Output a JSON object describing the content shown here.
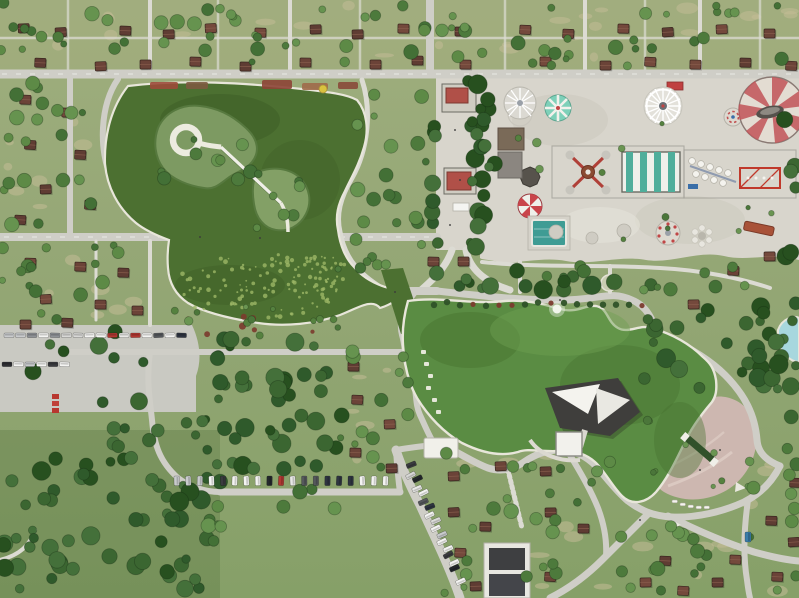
{
  "scene": {
    "type": "aerial-photo",
    "description": "Top-down drone photograph of a large urban park: two organic green ponds joined by a channel, an island with a white circular walkway and diagonal footbridge, a lakeside stage with white canopies, a pink waterfront plaza, an amusement park with striped tents and rides, grids of picnic cells with brown-roofed cabins, tree groves, and parking lots filled with cars.",
    "landmarks": [
      "upper pond with island spiral walkway",
      "causeway over upper pond",
      "lily-pad lobe",
      "channel footbridge",
      "lower pond with fountain",
      "lakeside stage",
      "pink plaza with water rill",
      "amusement park",
      "picnic cabin grid",
      "left parking lot",
      "diagonal parking road",
      "bottom-left forest",
      "waterslide pool at right edge"
    ]
  },
  "palette": {
    "grass_base": "#93a674",
    "grass_top": "#a8ad7e",
    "dirt": "#c2bc96",
    "road": "#cfcec7",
    "road_minor": "#dcdbd3",
    "concrete": "#d8d5cc",
    "lot": "#c9c9c2",
    "water_upper": "#4c7031",
    "water_lower": "#5a8c43",
    "water_edge": "#e8e6da",
    "pool": "#a7d7de",
    "plaza": "#cdb7b0",
    "plaza_path": "#decdc6",
    "rill": "#31512a",
    "stage": "#3f3e3c",
    "canopy": "#f4f3ee",
    "tent_red": "#c25458",
    "tent_cream": "#e3dcd2",
    "tent_teal": "#4fae9b",
    "stripe_white": "#eef0ea",
    "mint": "#7ed0b9",
    "umbrella_red": "#c9454b",
    "red_kiosk": "#b05048",
    "truss_red": "#c0392b"
  },
  "trees": {
    "dark": [
      "#2f5a2b",
      "#3b6631",
      "#27501f",
      "#44703a"
    ],
    "mid": [
      "#4d7a3c",
      "#5d8a46",
      "#437036",
      "#66934f"
    ],
    "small": [
      "#55813f",
      "#6a9552",
      "#4b763a"
    ],
    "edge": "rgba(20,40,16,.35)",
    "regions": [
      [
        0,
        2,
        795,
        64,
        70,
        "mid",
        1
      ],
      [
        2,
        80,
        100,
        152,
        20,
        "mid",
        2
      ],
      [
        2,
        244,
        150,
        84,
        16,
        "mid",
        3
      ],
      [
        185,
        334,
        158,
        148,
        44,
        "dark",
        4
      ],
      [
        0,
        458,
        208,
        138,
        56,
        "dark",
        5
      ],
      [
        336,
        350,
        72,
        118,
        13,
        "mid",
        6
      ],
      [
        430,
        452,
        180,
        144,
        26,
        "mid",
        7
      ],
      [
        616,
        522,
        182,
        74,
        18,
        "mid",
        8
      ],
      [
        742,
        440,
        56,
        82,
        9,
        "mid",
        9
      ],
      [
        466,
        80,
        30,
        182,
        16,
        "dark",
        10
      ],
      [
        428,
        82,
        10,
        166,
        8,
        "dark",
        11
      ],
      [
        476,
        82,
        12,
        166,
        8,
        "dark",
        12
      ],
      [
        356,
        88,
        70,
        140,
        14,
        "mid",
        13
      ],
      [
        338,
        202,
        86,
        82,
        10,
        "mid",
        14
      ],
      [
        430,
        270,
        248,
        28,
        16,
        "dark",
        15
      ],
      [
        642,
        298,
        148,
        92,
        26,
        "dark",
        16
      ],
      [
        756,
        302,
        42,
        126,
        10,
        "dark",
        17
      ],
      [
        782,
        82,
        16,
        176,
        6,
        "dark",
        18
      ],
      [
        160,
        110,
        92,
        74,
        9,
        "mid",
        19
      ],
      [
        256,
        172,
        54,
        56,
        7,
        "mid",
        20
      ],
      [
        172,
        302,
        168,
        38,
        12,
        "small",
        21
      ],
      [
        12,
        330,
        236,
        78,
        12,
        "dark",
        22
      ],
      [
        502,
        96,
        286,
        148,
        12,
        "small",
        23
      ],
      [
        490,
        264,
        288,
        28,
        10,
        "mid",
        24
      ],
      [
        644,
        402,
        112,
        92,
        8,
        "small",
        25
      ],
      [
        206,
        482,
        132,
        68,
        10,
        "mid",
        26
      ],
      [
        94,
        412,
        110,
        48,
        10,
        "dark",
        27
      ]
    ]
  },
  "dirt_regions": [
    [
      0,
      4,
      795,
      60,
      26
    ],
    [
      4,
      84,
      92,
      140,
      8
    ],
    [
      4,
      248,
      140,
      76,
      6
    ],
    [
      338,
      354,
      66,
      110,
      5
    ],
    [
      434,
      456,
      170,
      136,
      9
    ],
    [
      620,
      526,
      174,
      66,
      6
    ],
    [
      164,
      114,
      84,
      64,
      3
    ],
    [
      260,
      176,
      46,
      48,
      2
    ],
    [
      746,
      444,
      48,
      74,
      3
    ]
  ],
  "cabins": {
    "roof_colors": [
      "#6b4338",
      "#74493c",
      "#5f3c33"
    ],
    "positions": [
      [
        18,
        24
      ],
      [
        55,
        28
      ],
      [
        120,
        26
      ],
      [
        163,
        30
      ],
      [
        205,
        24
      ],
      [
        255,
        28
      ],
      [
        310,
        25
      ],
      [
        352,
        30
      ],
      [
        398,
        24
      ],
      [
        455,
        27
      ],
      [
        520,
        25
      ],
      [
        563,
        29
      ],
      [
        618,
        24
      ],
      [
        662,
        28
      ],
      [
        716,
        25
      ],
      [
        764,
        29
      ],
      [
        35,
        58
      ],
      [
        95,
        62
      ],
      [
        140,
        60
      ],
      [
        190,
        57
      ],
      [
        240,
        62
      ],
      [
        300,
        58
      ],
      [
        370,
        60
      ],
      [
        412,
        56
      ],
      [
        460,
        60
      ],
      [
        540,
        57
      ],
      [
        600,
        61
      ],
      [
        645,
        57
      ],
      [
        690,
        60
      ],
      [
        740,
        58
      ],
      [
        786,
        61
      ],
      [
        20,
        95
      ],
      [
        62,
        108
      ],
      [
        25,
        140
      ],
      [
        75,
        150
      ],
      [
        40,
        185
      ],
      [
        85,
        200
      ],
      [
        15,
        215
      ],
      [
        25,
        258
      ],
      [
        75,
        262
      ],
      [
        118,
        268
      ],
      [
        40,
        295
      ],
      [
        95,
        300
      ],
      [
        132,
        306
      ],
      [
        20,
        320
      ],
      [
        62,
        318
      ],
      [
        348,
        362
      ],
      [
        352,
        395
      ],
      [
        384,
        420
      ],
      [
        350,
        448
      ],
      [
        386,
        464
      ],
      [
        428,
        257
      ],
      [
        458,
        257
      ],
      [
        448,
        472
      ],
      [
        495,
        462
      ],
      [
        540,
        467
      ],
      [
        448,
        508
      ],
      [
        480,
        522
      ],
      [
        545,
        508
      ],
      [
        578,
        524
      ],
      [
        455,
        548
      ],
      [
        470,
        582
      ],
      [
        545,
        572
      ],
      [
        640,
        578
      ],
      [
        678,
        586
      ],
      [
        712,
        578
      ],
      [
        730,
        555
      ],
      [
        772,
        572
      ],
      [
        788,
        538
      ],
      [
        660,
        556
      ],
      [
        790,
        478
      ],
      [
        766,
        516
      ],
      [
        688,
        300
      ],
      [
        728,
        266
      ],
      [
        764,
        252
      ]
    ]
  },
  "lily": {
    "pads": [
      {
        "cx": 256,
        "cy": 286,
        "rx": 82,
        "ry": 34,
        "n": 95,
        "seed": 31
      },
      {
        "cx": 322,
        "cy": 278,
        "rx": 28,
        "ry": 26,
        "n": 40,
        "seed": 32
      }
    ],
    "color": "#9cb766"
  },
  "bushes": {
    "shore_row": {
      "x0": 434,
      "x1": 648,
      "y": 304,
      "step": 13,
      "seed": 33
    },
    "green": "#2f5228",
    "red": "#7b3b2e",
    "lily_red_n": 8
  },
  "cars": {
    "colors": [
      "#f4f4f2",
      "#2e2f33",
      "#c9cbcd",
      "#f4f4f2",
      "#8f9296",
      "#f4f4f2",
      "#3a3b3f",
      "#d8d8d6",
      "#f4f4f2",
      "#24282c",
      "#e8e8e6",
      "#b23832",
      "#f4f4f2",
      "#55585c",
      "#f4f4f2",
      "#2e3440",
      "#f4f4f2",
      "#4a4e52",
      "#dcdcda"
    ],
    "rows": [
      {
        "x": 4,
        "y": 333,
        "n": 16,
        "dx": 11.5,
        "w": 10,
        "h": 4.6,
        "vert": false,
        "seed": 41
      },
      {
        "x": 2,
        "y": 362,
        "n": 6,
        "dx": 11.5,
        "w": 10,
        "h": 4.6,
        "vert": false,
        "seed": 42
      },
      {
        "x": 174,
        "y": 476,
        "n": 19,
        "dx": 11.6,
        "w": 5.4,
        "h": 9.6,
        "vert": true,
        "seed": 43
      }
    ],
    "diagonals": [
      {
        "x1": 404,
        "y1": 468,
        "x2": 447,
        "y2": 566,
        "n": 8,
        "side": -8,
        "seed": 44
      },
      {
        "x1": 418,
        "y1": 472,
        "x2": 468,
        "y2": 578,
        "n": 9,
        "side": 8,
        "seed": 45
      }
    ],
    "singles": [
      {
        "x": 745,
        "y": 532,
        "w": 6,
        "h": 10,
        "c": "#3a7ca8"
      }
    ]
  },
  "shore_stones": [
    [
      421,
      350
    ],
    [
      424,
      362
    ],
    [
      428,
      374
    ],
    [
      426,
      386
    ],
    [
      432,
      398
    ],
    [
      436,
      410
    ]
  ],
  "boats": [
    [
      672,
      500
    ],
    [
      680,
      503
    ],
    [
      688,
      505
    ],
    [
      696,
      506
    ],
    [
      704,
      506
    ]
  ],
  "flowerbeds": {
    "beds": [
      [
        150,
        82,
        28,
        7,
        "#9c4a3a"
      ],
      [
        186,
        82,
        22,
        7,
        "#7c5a40"
      ],
      [
        262,
        80,
        30,
        9,
        "#8d4436"
      ],
      [
        302,
        83,
        26,
        7,
        "#a06a4a"
      ],
      [
        338,
        82,
        20,
        7,
        "#8a4a3a"
      ]
    ],
    "yellow_umbrella": {
      "x": 323,
      "y": 89,
      "r": 4,
      "c": "#d9c23f"
    }
  },
  "pedestrians": [
    [
      455,
      130
    ],
    [
      460,
      180
    ],
    [
      450,
      225
    ],
    [
      395,
      292
    ],
    [
      700,
      470
    ],
    [
      720,
      450
    ],
    [
      200,
      237
    ],
    [
      260,
      238
    ],
    [
      560,
      300
    ],
    [
      640,
      520
    ]
  ],
  "rides": [
    "swing-ride",
    "mint-carousel",
    "food-stall",
    "white-spoke-ride",
    "kids-carousel",
    "big-swirl-tent",
    "top-spin",
    "striped-pavilion",
    "gondola-ride",
    "red-truss-ride",
    "red-umbrella",
    "plunge-pool",
    "round-pavilion",
    "flower-ride",
    "tilted-slide"
  ]
}
